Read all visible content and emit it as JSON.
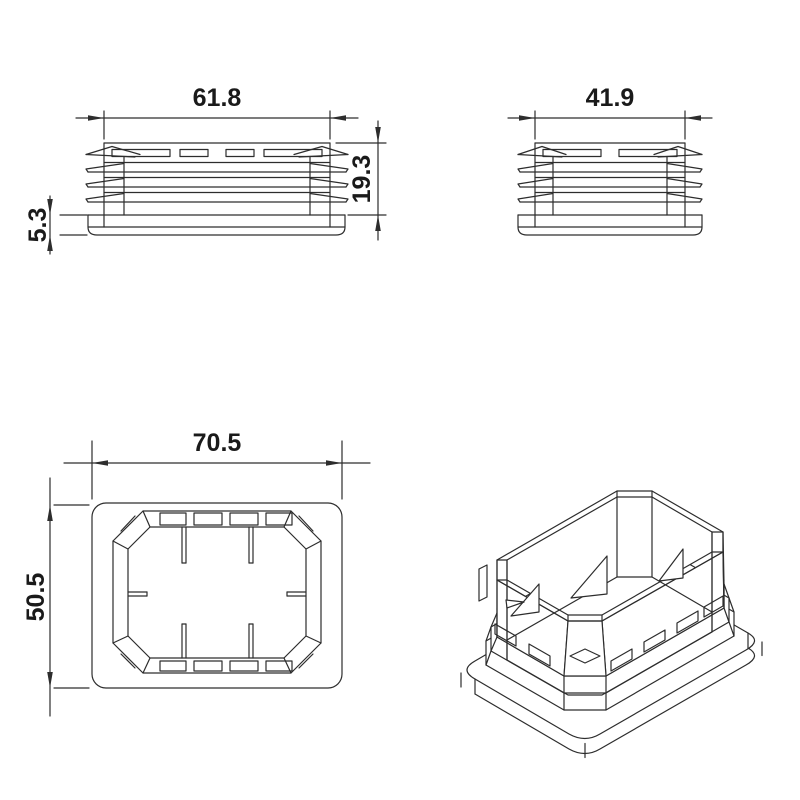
{
  "drawing": {
    "type": "technical-drawing",
    "part": "rectangular-tube-insert-end-cap",
    "views": {
      "front": {
        "width_label": "61.8",
        "height_label": "19.3",
        "flange_label": "5.3"
      },
      "side": {
        "width_label": "41.9"
      },
      "top": {
        "width_label": "70.5",
        "height_label": "50.5"
      },
      "isometric": {}
    },
    "style": {
      "line_color": "#2d2d2d",
      "text_color": "#1a1a1a",
      "background": "#ffffff"
    }
  }
}
